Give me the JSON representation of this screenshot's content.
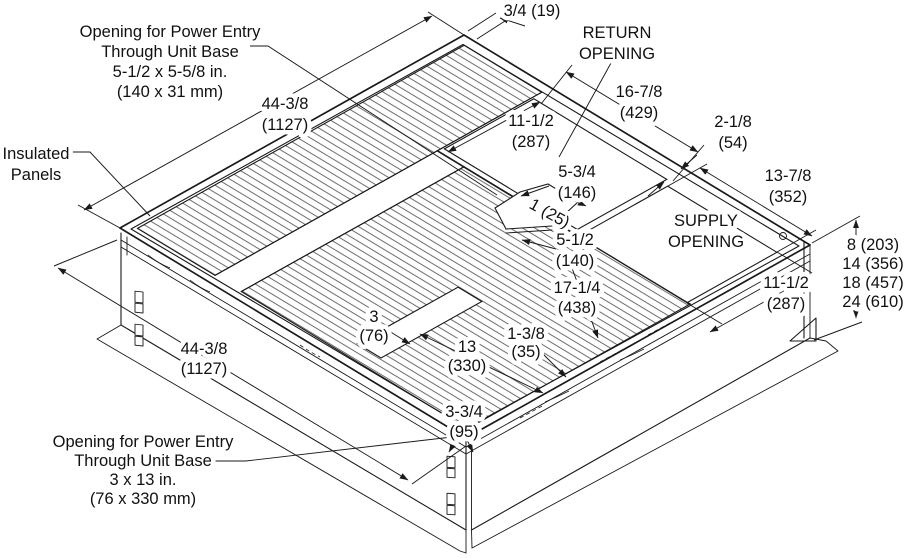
{
  "diagram": {
    "type": "isometric-technical-drawing",
    "subject": "Unit base with insulated panels, return/supply openings and power entry openings",
    "colors": {
      "line": "#1a1a1a",
      "background": "#ffffff",
      "hatch": "#3a3a3a"
    },
    "labels": [
      {
        "name": "callout-power-entry-top",
        "lines": [
          "Opening for Power Entry",
          "Through Unit Base",
          "5-1/2 x 5-5/8 in.",
          "(140 x 31 mm)"
        ],
        "x": 170,
        "y": 37,
        "lh": 20,
        "anchor": "middle"
      },
      {
        "name": "dim-three-quarter",
        "lines": [
          "3/4 (19)"
        ],
        "x": 532,
        "y": 16,
        "lh": 20,
        "anchor": "middle"
      },
      {
        "name": "return-opening-label",
        "lines": [
          "RETURN",
          "OPENING"
        ],
        "x": 617,
        "y": 38,
        "lh": 21,
        "anchor": "middle"
      },
      {
        "name": "dim-44-38-top",
        "lines": [
          "44-3/8",
          "(1127)"
        ],
        "x": 285,
        "y": 109,
        "lh": 21,
        "anchor": "middle"
      },
      {
        "name": "dim-16-78",
        "lines": [
          "16-7/8",
          "(429)"
        ],
        "x": 639,
        "y": 97,
        "lh": 21,
        "anchor": "middle"
      },
      {
        "name": "dim-11-12-return",
        "lines": [
          "11-1/2",
          "(287)"
        ],
        "x": 531,
        "y": 126,
        "lh": 21,
        "anchor": "middle"
      },
      {
        "name": "dim-2-18",
        "lines": [
          "2-1/8",
          "(54)"
        ],
        "x": 733,
        "y": 127,
        "lh": 21,
        "anchor": "middle"
      },
      {
        "name": "insulated-panels-label",
        "lines": [
          "Insulated",
          "Panels"
        ],
        "x": 36,
        "y": 159,
        "lh": 21,
        "anchor": "middle"
      },
      {
        "name": "dim-13-78",
        "lines": [
          "13-7/8",
          "(352)"
        ],
        "x": 788,
        "y": 181,
        "lh": 21,
        "anchor": "middle"
      },
      {
        "name": "dim-5-34",
        "lines": [
          "5-3/4",
          "(146)"
        ],
        "x": 577,
        "y": 177,
        "lh": 21,
        "anchor": "middle"
      },
      {
        "name": "dim-1-25",
        "lines": [
          "1 (25)"
        ],
        "x": 547,
        "y": 218,
        "lh": 20,
        "anchor": "middle",
        "rotate": 29
      },
      {
        "name": "supply-opening-label",
        "lines": [
          "SUPPLY",
          "OPENING"
        ],
        "x": 706,
        "y": 226,
        "lh": 21,
        "anchor": "middle"
      },
      {
        "name": "dim-5-12",
        "lines": [
          "5-1/2",
          "(140)"
        ],
        "x": 575,
        "y": 245,
        "lh": 21,
        "anchor": "middle"
      },
      {
        "name": "height-options",
        "lines": [
          "8 (203)",
          "14 (356)",
          "18 (457)",
          "24 (610)"
        ],
        "x": 873,
        "y": 250,
        "lh": 19,
        "anchor": "middle"
      },
      {
        "name": "dim-17-14",
        "lines": [
          "17-1/4",
          "(438)"
        ],
        "x": 577,
        "y": 293,
        "lh": 20,
        "anchor": "middle"
      },
      {
        "name": "dim-11-12-supply",
        "lines": [
          "11-1/2",
          "(287)"
        ],
        "x": 786,
        "y": 288,
        "lh": 21,
        "anchor": "middle"
      },
      {
        "name": "dim-3-76",
        "lines": [
          "3",
          "(76)"
        ],
        "x": 374,
        "y": 322,
        "lh": 19,
        "anchor": "middle"
      },
      {
        "name": "dim-1-38",
        "lines": [
          "1-3/8",
          "(35)"
        ],
        "x": 526,
        "y": 339,
        "lh": 18,
        "anchor": "middle"
      },
      {
        "name": "dim-13-330",
        "lines": [
          "13",
          "(330)"
        ],
        "x": 467,
        "y": 352,
        "lh": 19,
        "anchor": "middle"
      },
      {
        "name": "dim-44-38-bottom",
        "lines": [
          "44-3/8",
          "(1127)"
        ],
        "x": 204,
        "y": 354,
        "lh": 20,
        "anchor": "middle"
      },
      {
        "name": "dim-3-34",
        "lines": [
          "3-3/4",
          "(95)"
        ],
        "x": 464,
        "y": 417,
        "lh": 20,
        "anchor": "middle"
      },
      {
        "name": "callout-power-entry-bottom",
        "lines": [
          "Opening for Power Entry",
          "Through Unit Base",
          "3 x 13 in.",
          "(76 x 330 mm)"
        ],
        "x": 143,
        "y": 447,
        "lh": 19,
        "anchor": "middle"
      }
    ]
  }
}
